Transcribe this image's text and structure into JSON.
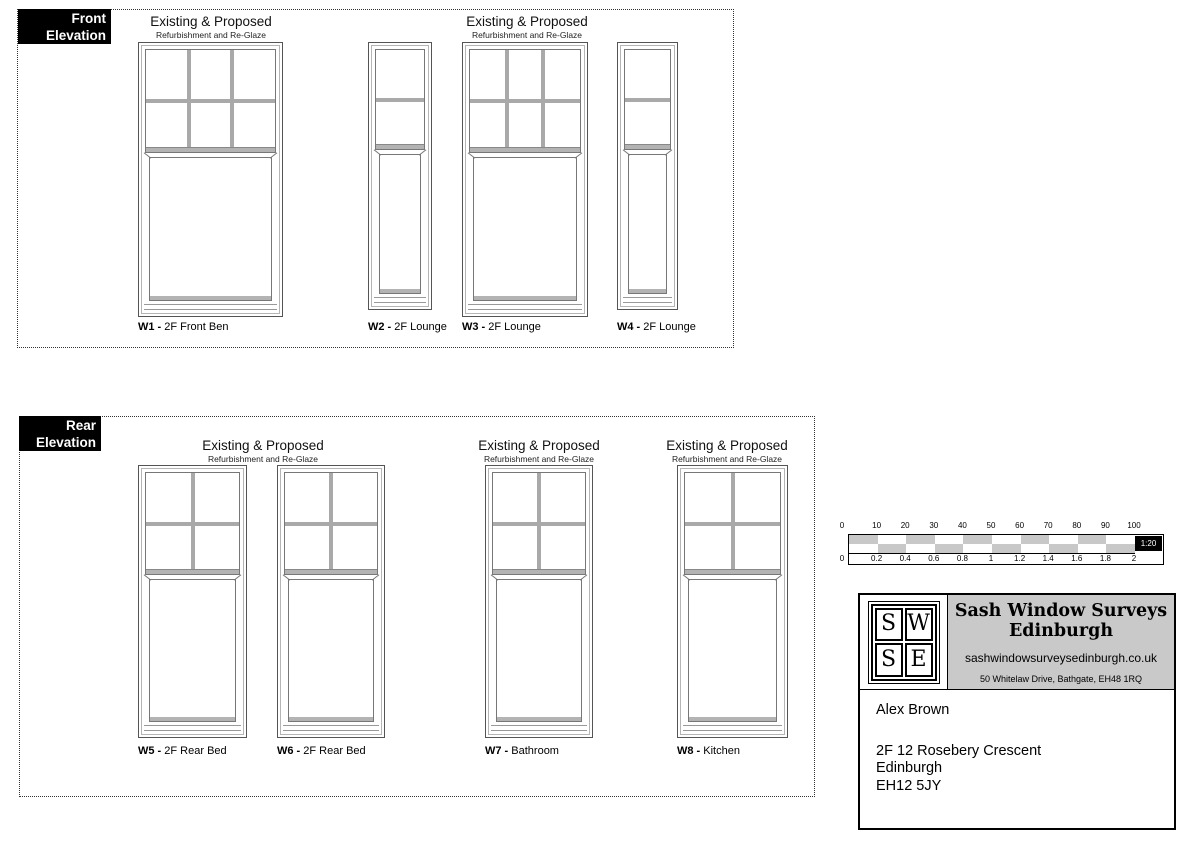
{
  "front_elevation": {
    "section_label": {
      "line1": "Front",
      "line2": "Elevation"
    },
    "headings": [
      {
        "title": "Existing & Proposed",
        "subtitle": "Refurbishment and Re-Glaze"
      },
      {
        "title": "Existing & Proposed",
        "subtitle": "Refurbishment and Re-Glaze"
      }
    ],
    "label_y": 321,
    "windows": [
      {
        "id": "W1",
        "name": "2F Front Ben",
        "x": 138,
        "y": 42,
        "w": 145,
        "h": 275,
        "top_cols": 3,
        "top_rows": 2
      },
      {
        "id": "W2",
        "name": "2F Lounge",
        "x": 368,
        "y": 42,
        "w": 64,
        "h": 268,
        "top_cols": 1,
        "top_rows": 2
      },
      {
        "id": "W3",
        "name": "2F Lounge",
        "x": 462,
        "y": 42,
        "w": 126,
        "h": 275,
        "top_cols": 3,
        "top_rows": 2
      },
      {
        "id": "W4",
        "name": "2F Lounge",
        "x": 617,
        "y": 42,
        "w": 61,
        "h": 268,
        "top_cols": 1,
        "top_rows": 2
      }
    ]
  },
  "rear_elevation": {
    "section_label": {
      "line1": "Rear",
      "line2": "Elevation"
    },
    "headings": [
      {
        "title": "Existing & Proposed",
        "subtitle": "Refurbishment and Re-Glaze"
      },
      {
        "title": "Existing & Proposed",
        "subtitle": "Refurbishment and Re-Glaze"
      },
      {
        "title": "Existing & Proposed",
        "subtitle": "Refurbishment and Re-Glaze"
      }
    ],
    "label_y": 745,
    "windows": [
      {
        "id": "W5",
        "name": "2F Rear Bed",
        "x": 138,
        "y": 465,
        "w": 109,
        "h": 273,
        "top_cols": 2,
        "top_rows": 2
      },
      {
        "id": "W6",
        "name": "2F Rear Bed",
        "x": 277,
        "y": 465,
        "w": 108,
        "h": 273,
        "top_cols": 2,
        "top_rows": 2
      },
      {
        "id": "W7",
        "name": "Bathroom",
        "x": 485,
        "y": 465,
        "w": 108,
        "h": 273,
        "top_cols": 2,
        "top_rows": 2
      },
      {
        "id": "W8",
        "name": "Kitchen",
        "x": 677,
        "y": 465,
        "w": 111,
        "h": 273,
        "top_cols": 2,
        "top_rows": 2
      }
    ]
  },
  "scale_bar": {
    "segments": 10,
    "segment_w": 28.6,
    "checker_color": "#c8c8c8",
    "top_labels": [
      "0",
      "10",
      "20",
      "30",
      "40",
      "50",
      "60",
      "70",
      "80",
      "90",
      "100"
    ],
    "bottom_labels": [
      "0",
      "0.2",
      "0.4",
      "0.6",
      "0.8",
      "1",
      "1.2",
      "1.4",
      "1.6",
      "1.8",
      "2"
    ],
    "ratio_label": "1:20"
  },
  "title_block": {
    "logo_letters": [
      "S",
      "W",
      "S",
      "E"
    ],
    "company_name_line1": "Sash Window Surveys",
    "company_name_line2": "Edinburgh",
    "website": "sashwindowsurveysedinburgh.co.uk",
    "company_address": "50 Whitelaw Drive, Bathgate, EH48 1RQ",
    "client": {
      "name": "Alex Brown",
      "address_line1": "2F 12 Rosebery Crescent",
      "address_line2": "Edinburgh",
      "address_line3": "EH12 5JY"
    }
  }
}
